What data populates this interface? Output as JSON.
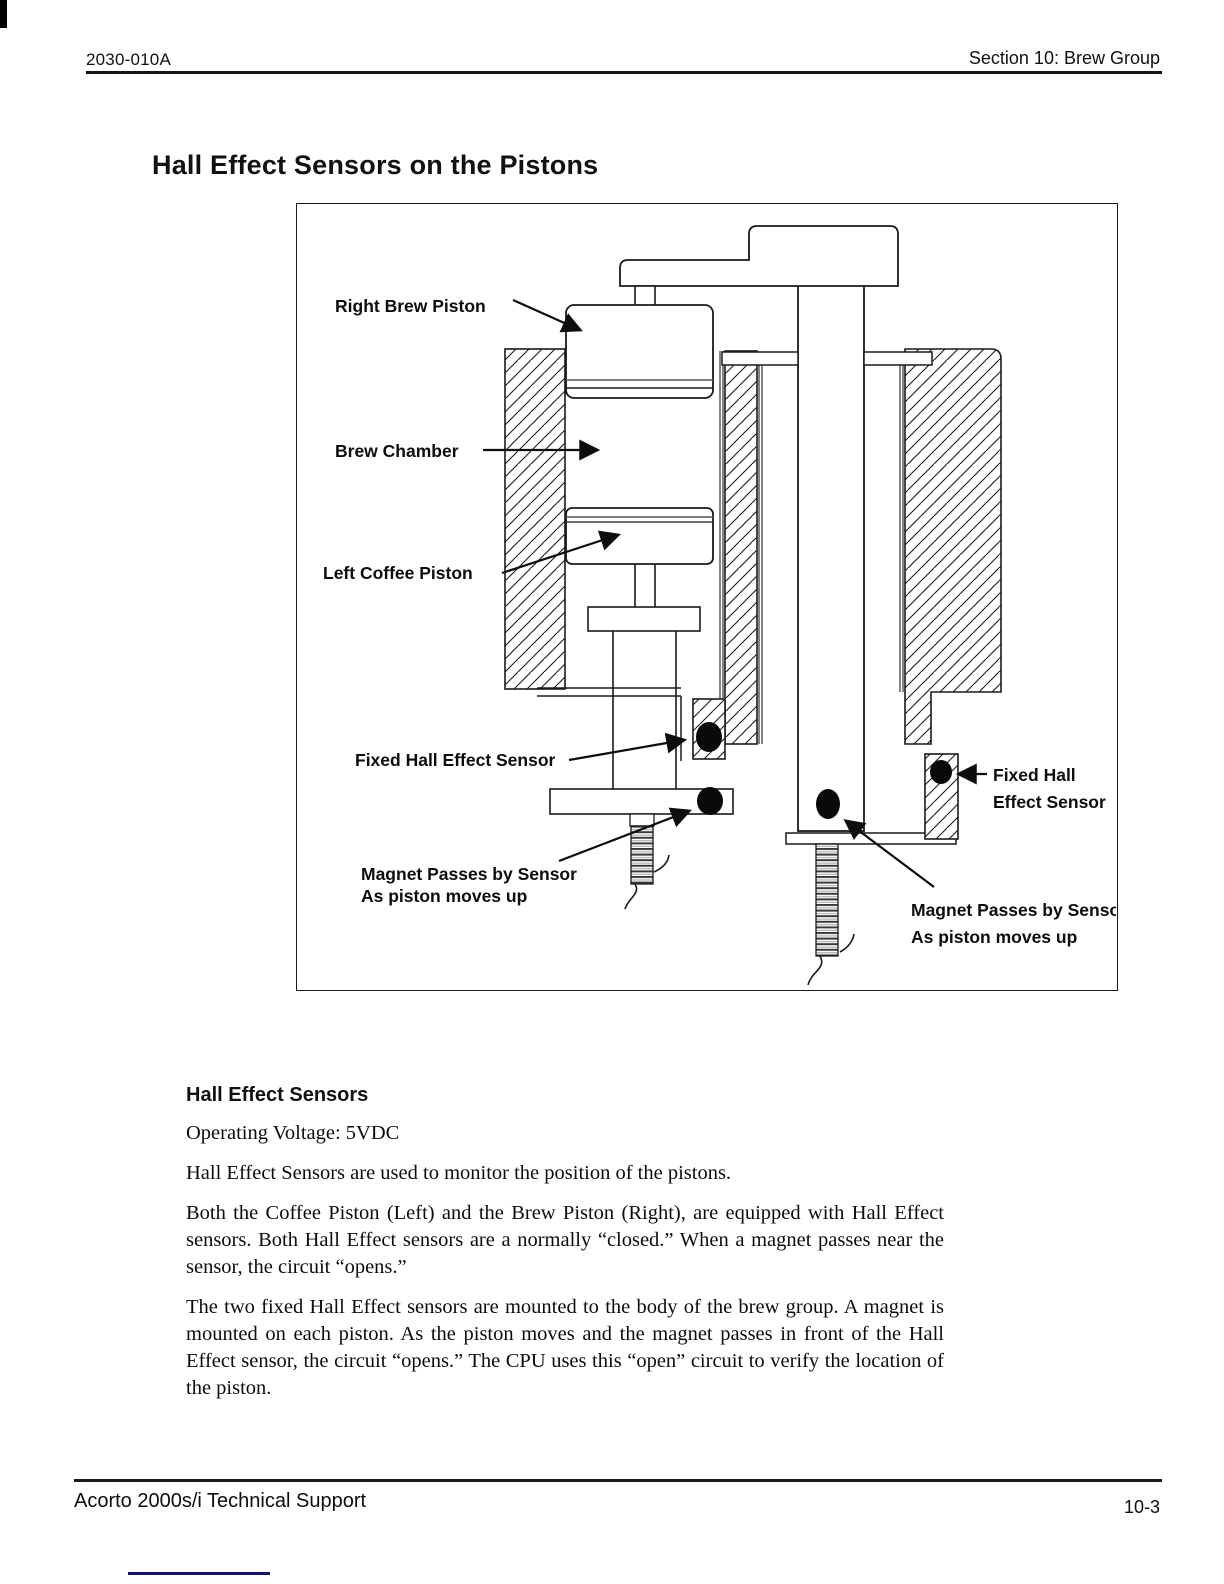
{
  "header": {
    "doc_number": "2030-010A",
    "section": "Section 10: Brew Group"
  },
  "title": "Hall Effect Sensors on the Pistons",
  "diagram": {
    "labels": {
      "right_brew_piston": "Right Brew Piston",
      "brew_chamber": "Brew Chamber",
      "left_coffee_piston": "Left Coffee Piston",
      "fixed_hall_left": "Fixed Hall Effect Sensor",
      "magnet_left_line1": "Magnet Passes by Sensor",
      "magnet_left_line2": "As piston moves up",
      "fixed_hall_right_line1": "Fixed Hall",
      "fixed_hall_right_line2": "Effect Sensor",
      "magnet_right_line1": "Magnet Passes by Sensor",
      "magnet_right_line2": "As piston moves up"
    }
  },
  "body": {
    "heading": "Hall Effect Sensors",
    "voltage": "Operating Voltage: 5VDC",
    "para1": "Hall Effect Sensors are used to monitor the position of the pistons.",
    "para2": "Both the Coffee Piston (Left) and the Brew Piston (Right), are equipped with Hall Effect sensors.  Both Hall Effect sensors are a normally “closed.”  When a magnet passes near the sensor, the circuit “opens.”",
    "para3": "The two fixed Hall Effect sensors are mounted to the body of the brew group.  A magnet is mounted on each piston.  As the piston moves and the magnet passes in front of the Hall Effect sensor, the circuit “opens.”  The CPU uses this “open” circuit to verify the location of the piston."
  },
  "footer": {
    "left": "Acorto 2000s/i Technical Support",
    "page": "10-3"
  },
  "colors": {
    "accent_line": "#10107e",
    "ink": "#1a1a1a"
  }
}
